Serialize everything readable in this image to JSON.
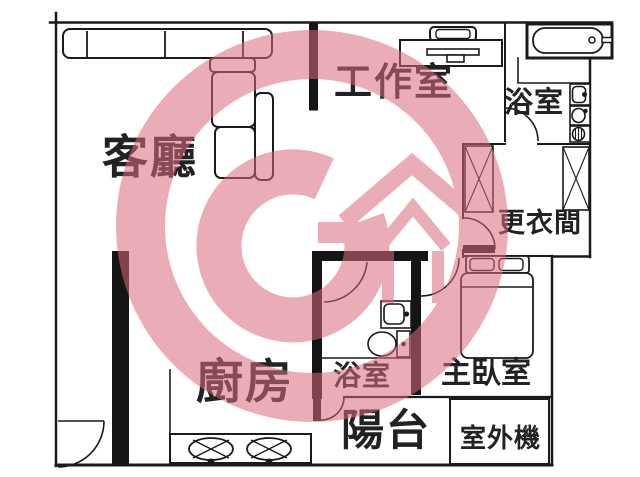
{
  "plan": {
    "title": "apartment-floor-plan",
    "rooms": {
      "living_room": {
        "label": "客廳"
      },
      "studio": {
        "label": "工作室"
      },
      "bathroom_top": {
        "label": "浴室"
      },
      "dressing_room": {
        "label": "更衣間"
      },
      "kitchen": {
        "label": "廚房"
      },
      "bathroom_bottom": {
        "label": "浴室"
      },
      "master_bedroom": {
        "label": "主臥室"
      },
      "balcony": {
        "label": "陽台"
      },
      "ac_unit": {
        "label": "室外機"
      }
    },
    "fixtures": [
      "l-shaped-sofa",
      "desk",
      "office-chair",
      "bathtub",
      "washbasin",
      "toilet",
      "washing-machine",
      "wardrobe",
      "double-bed",
      "two-burner-stove",
      "door-swings"
    ],
    "colors": {
      "wall": "#1a1a1a",
      "label_text": "#222222",
      "watermark_pink": "#d96b7e",
      "background": "#ffffff"
    }
  },
  "watermark": {
    "description": "agency-logo: ring with letter G, house outline and up-arrow",
    "opacity": 0.55
  }
}
